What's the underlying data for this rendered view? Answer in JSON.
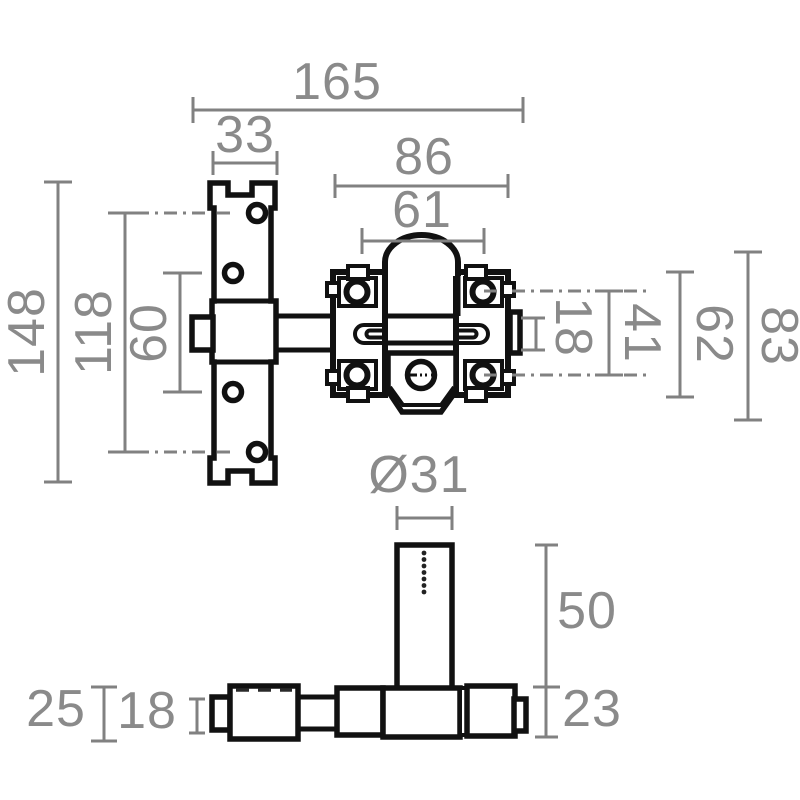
{
  "drawing": {
    "description": "Technical dimension drawing of a security rim bolt lock, front view and bottom view",
    "colors": {
      "background": "#ffffff",
      "part_outline": "#111111",
      "dimension_lines": "#818181",
      "dimension_text": "#8a8a8a"
    },
    "labels": {
      "total_width": "165",
      "plate_width": "33",
      "body_width": "86",
      "body_screw_spacing_h": "61",
      "plate_height": "148",
      "plate_screw_span_outer": "118",
      "plate_screw_span_inner": "60",
      "bolt_bar_height": "18",
      "body_screw_spacing_v": "41",
      "body_height": "62",
      "body_overall_height": "83",
      "cylinder_diameter": "Ø31",
      "cylinder_length": "50",
      "bar_depth": "23",
      "block_depth": "25",
      "bar_end_depth": "18"
    }
  }
}
